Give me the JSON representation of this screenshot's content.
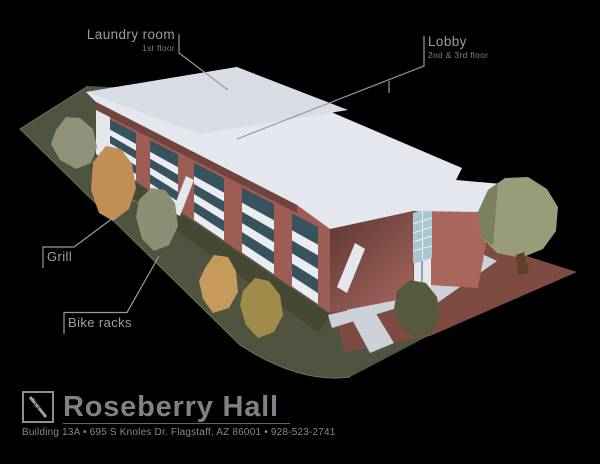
{
  "callouts": [
    {
      "id": "laundry",
      "title": "Laundry room",
      "subtitle": "1st floor"
    },
    {
      "id": "lobby",
      "title": "Lobby",
      "subtitle": "2nd & 3rd floor"
    },
    {
      "id": "grill",
      "title": "Grill",
      "subtitle": ""
    },
    {
      "id": "bike_racks",
      "title": "Bike racks",
      "subtitle": ""
    }
  ],
  "footer": {
    "logo": "university-crest-logo",
    "building_name": "Roseberry Hall",
    "address_line": "Building 13A • 695 S Knoles Dr. Flagstaff, AZ 86001  •  928-523-2741"
  },
  "illustration": {
    "subject": "isometric 3-story brick residence hall with flat white roof, lawn, bushes, trees and brick plaza walkways",
    "colors": {
      "background": "#000000",
      "roof": "#e4e7ed",
      "roof_shaded": "#d8dce5",
      "brick": "#9d5d55",
      "brick_lit": "#a8665d",
      "brick_shadow": "#5f3833",
      "window": "#36535f",
      "railing": "#e9ecf0",
      "grass": "#4f5440",
      "plaza_brick": "#7d4b41",
      "walkway": "#ccd1d8",
      "glass": "#a9c6cf",
      "foliage_olive": "#90917a",
      "foliage_orange": "#c18e55",
      "foliage_tan": "#ab9150",
      "tree": "#989c79",
      "leader_line": "#97999b",
      "label_text": "#9b9d9b",
      "footer_text": "#7e8286"
    }
  }
}
